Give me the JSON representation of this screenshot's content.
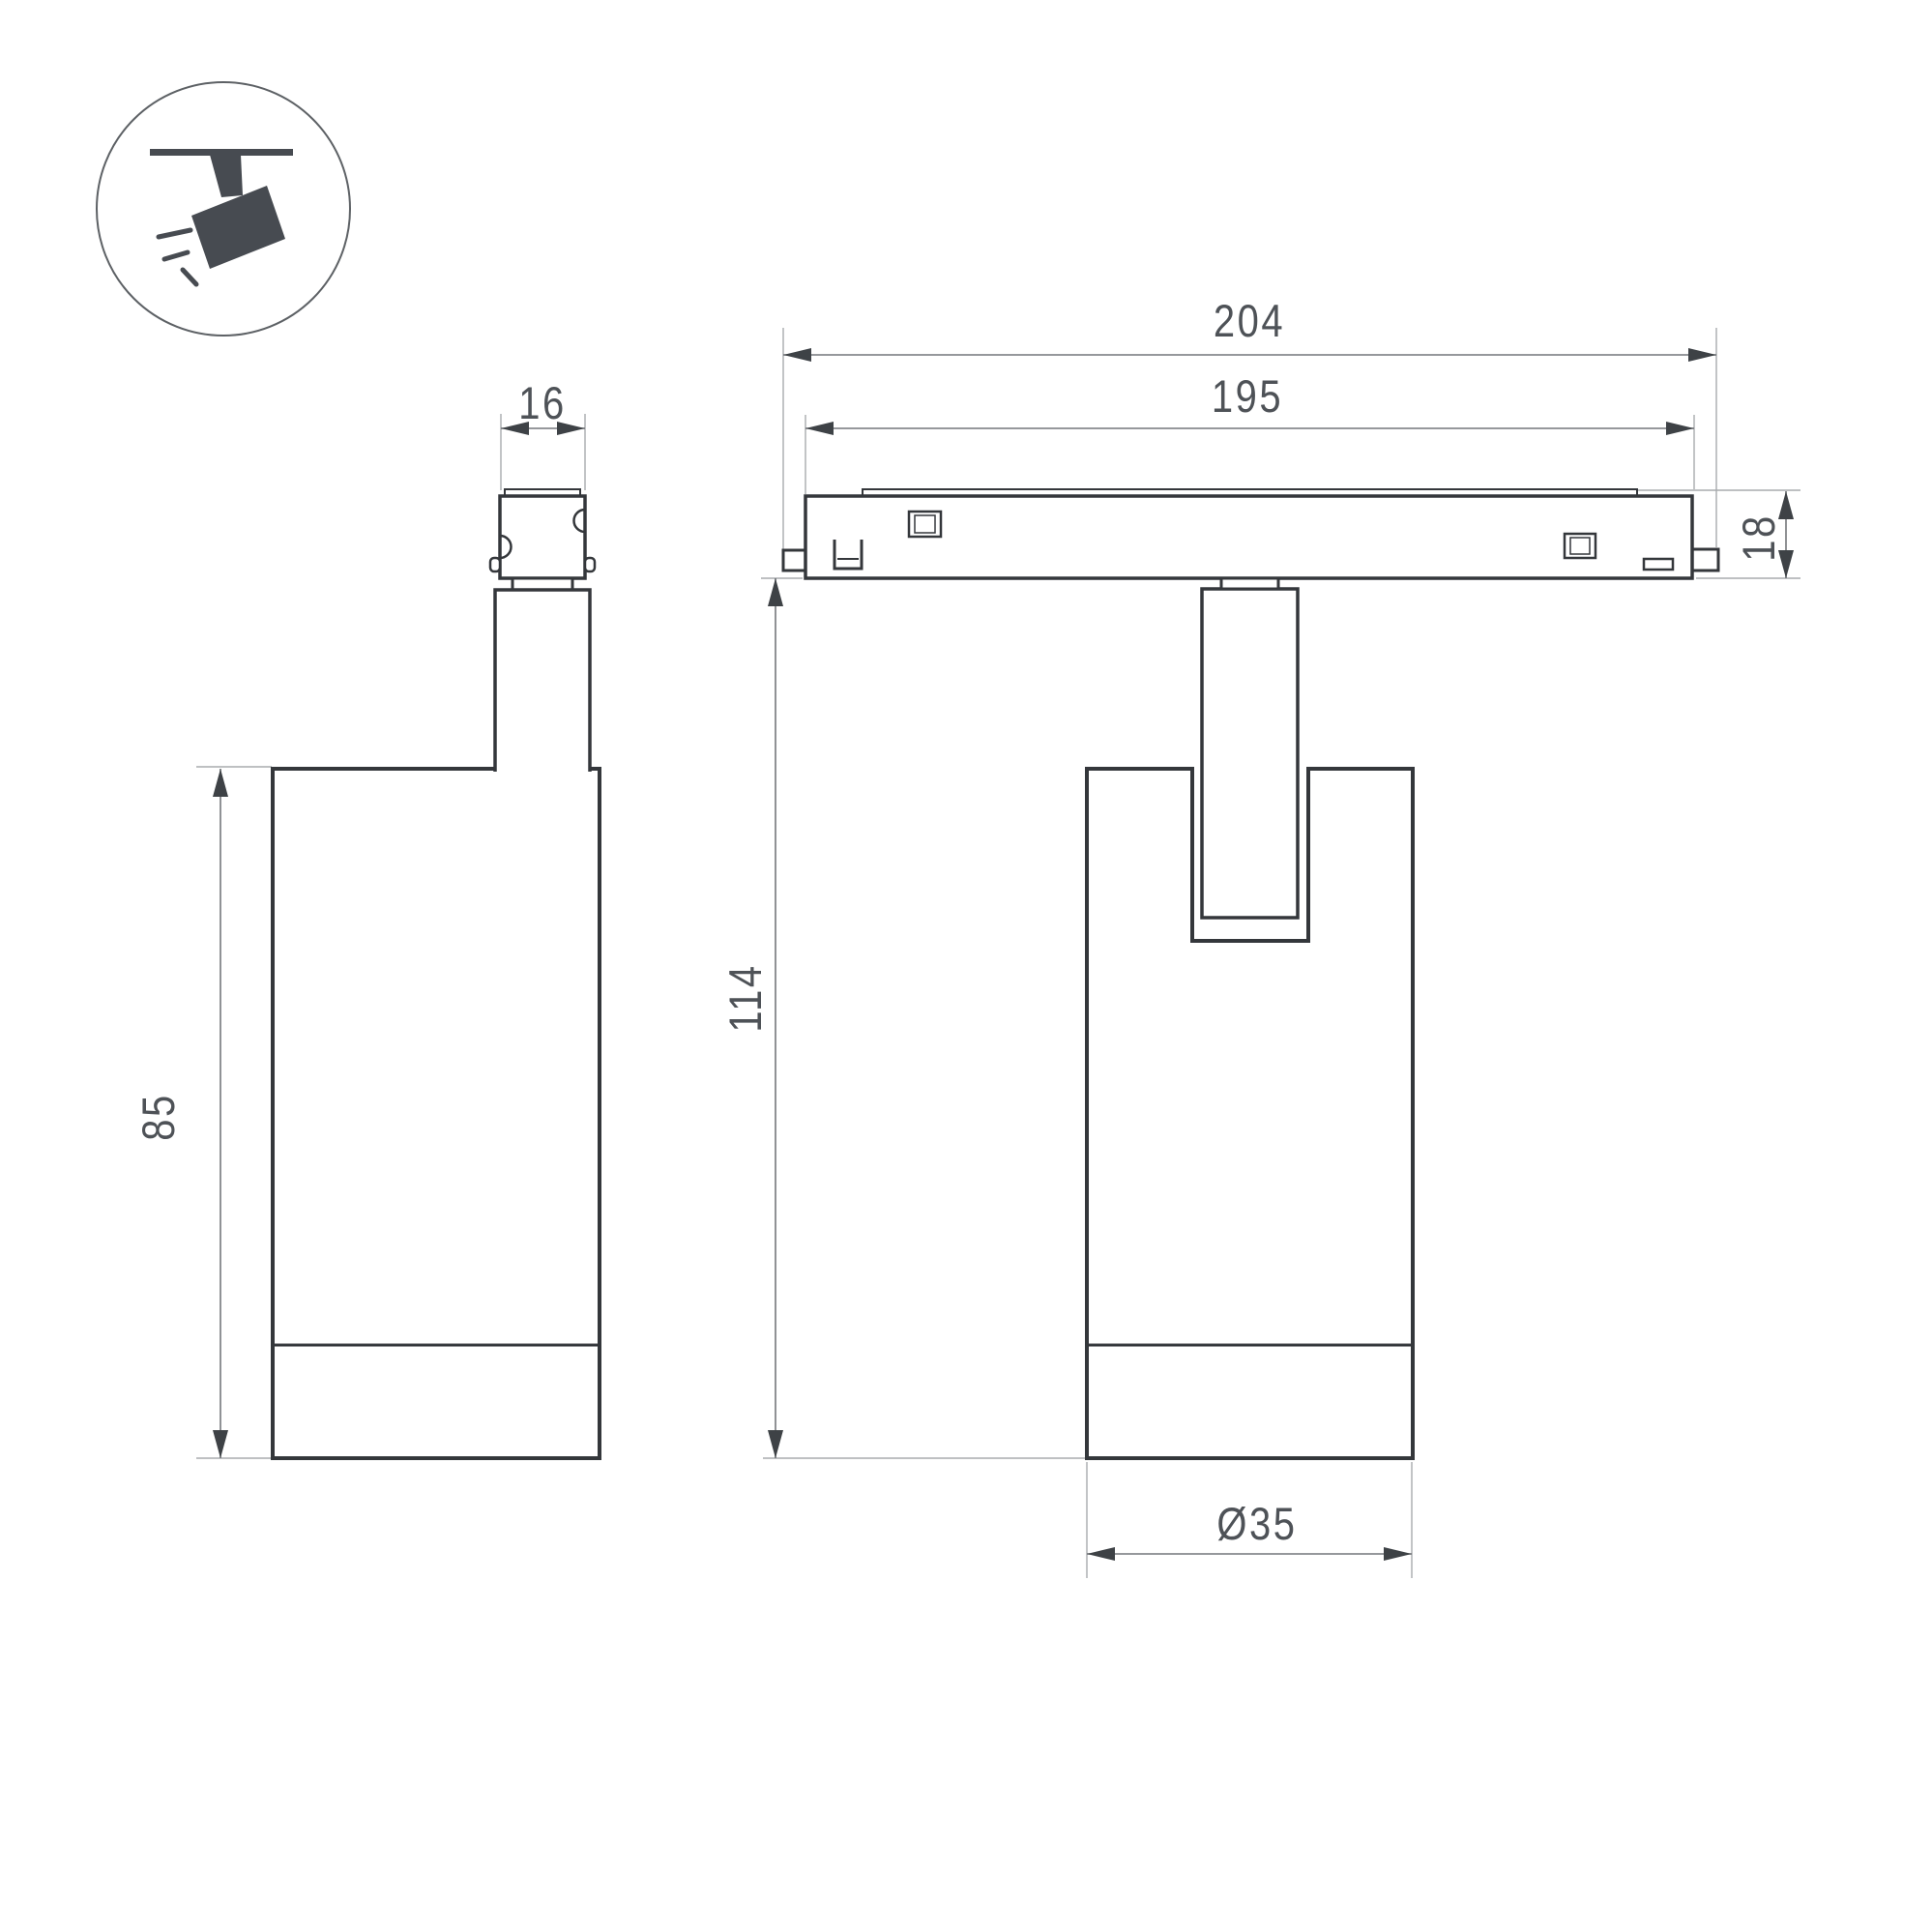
{
  "drawing": {
    "type": "technical-dimension-drawing",
    "subject": "track-mounted spotlight luminaire, two orthographic views"
  },
  "icon": {
    "name": "track-spotlight-icon",
    "description": "spotlight hanging from ceiling track with light rays"
  },
  "dimensions": {
    "track_length": "204",
    "track_inner_length": "195",
    "adapter_width": "16",
    "track_height": "18",
    "body_height": "85",
    "total_height": "114",
    "body_diameter": "Ø35"
  },
  "colors": {
    "background": "#ffffff",
    "outline": "#34373b",
    "dimension_line": "#74777b",
    "extension_line": "#a8abae",
    "arrow": "#3e4246",
    "label_text": "#4e5257",
    "icon": "#474b51"
  }
}
